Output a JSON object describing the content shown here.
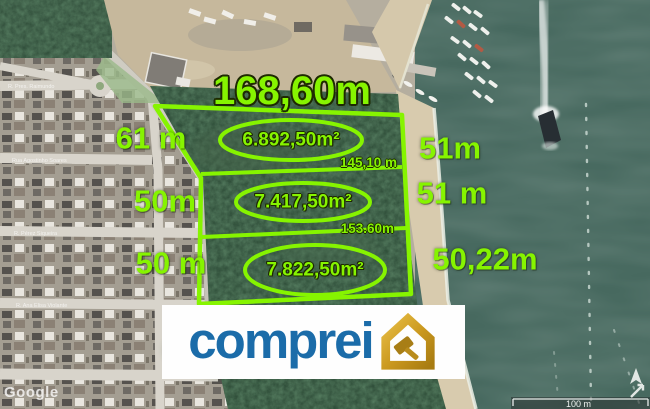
{
  "annotations": {
    "accent_color": "#86f400",
    "top_length": "168,60m",
    "left_lengths": [
      "61 m",
      "50m",
      "50 m"
    ],
    "right_lengths": [
      "51m",
      "51 m",
      "50,22m"
    ],
    "inner_lengths": [
      "145,10 m",
      "153.60m"
    ],
    "parcels": [
      {
        "area": "6.892,50m²"
      },
      {
        "area": "7.417,50m²"
      },
      {
        "area": "7.822,50m²"
      }
    ]
  },
  "logo": {
    "text": "comprei",
    "brand_blue": "#1b6ca9",
    "brand_gold": "#c9971d",
    "icon": "house-gavel-icon"
  },
  "map": {
    "attribution": "Google",
    "scale_label": "100 m",
    "street_labels": [
      "R. Pres. Raimundo",
      "Rua Agostinho Soares",
      "R. Pérez Siqueira",
      "R. Ana Elisa Violante"
    ]
  }
}
